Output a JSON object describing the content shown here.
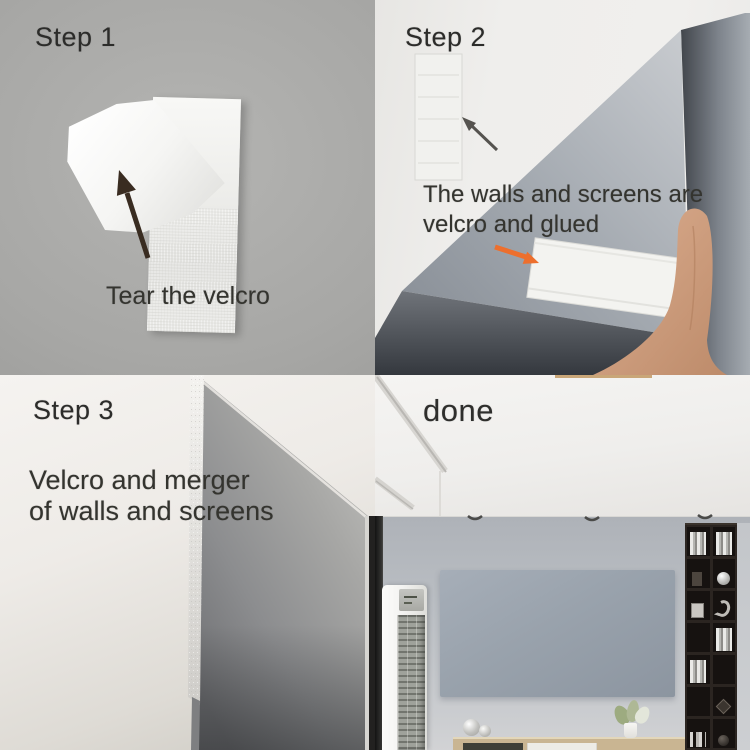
{
  "panels": {
    "step1": {
      "label": "Step 1",
      "caption": "Tear the velcro"
    },
    "step2": {
      "label": "Step 2",
      "caption_line1": "The walls and screens are",
      "caption_line2": "velcro and glued"
    },
    "step3": {
      "label": "Step 3",
      "caption_line1": "Velcro and merger",
      "caption_line2": "of walls and screens"
    },
    "done": {
      "label": "done"
    }
  },
  "colors": {
    "step1_background": "#a7a7a5",
    "step2_background": "#efeeec",
    "step3_wall": "#efede9",
    "screen_gray": "#8f959c",
    "living_room_screen": "#99a2ac",
    "arrow_dark": "#392c21",
    "arrow_orange": "#ed6f2d",
    "hand_skin": "#d0a083",
    "velcro_white": "#f3f3f0",
    "shelf_dark": "#2b2521",
    "cabinet_wood": "#c9b592"
  }
}
